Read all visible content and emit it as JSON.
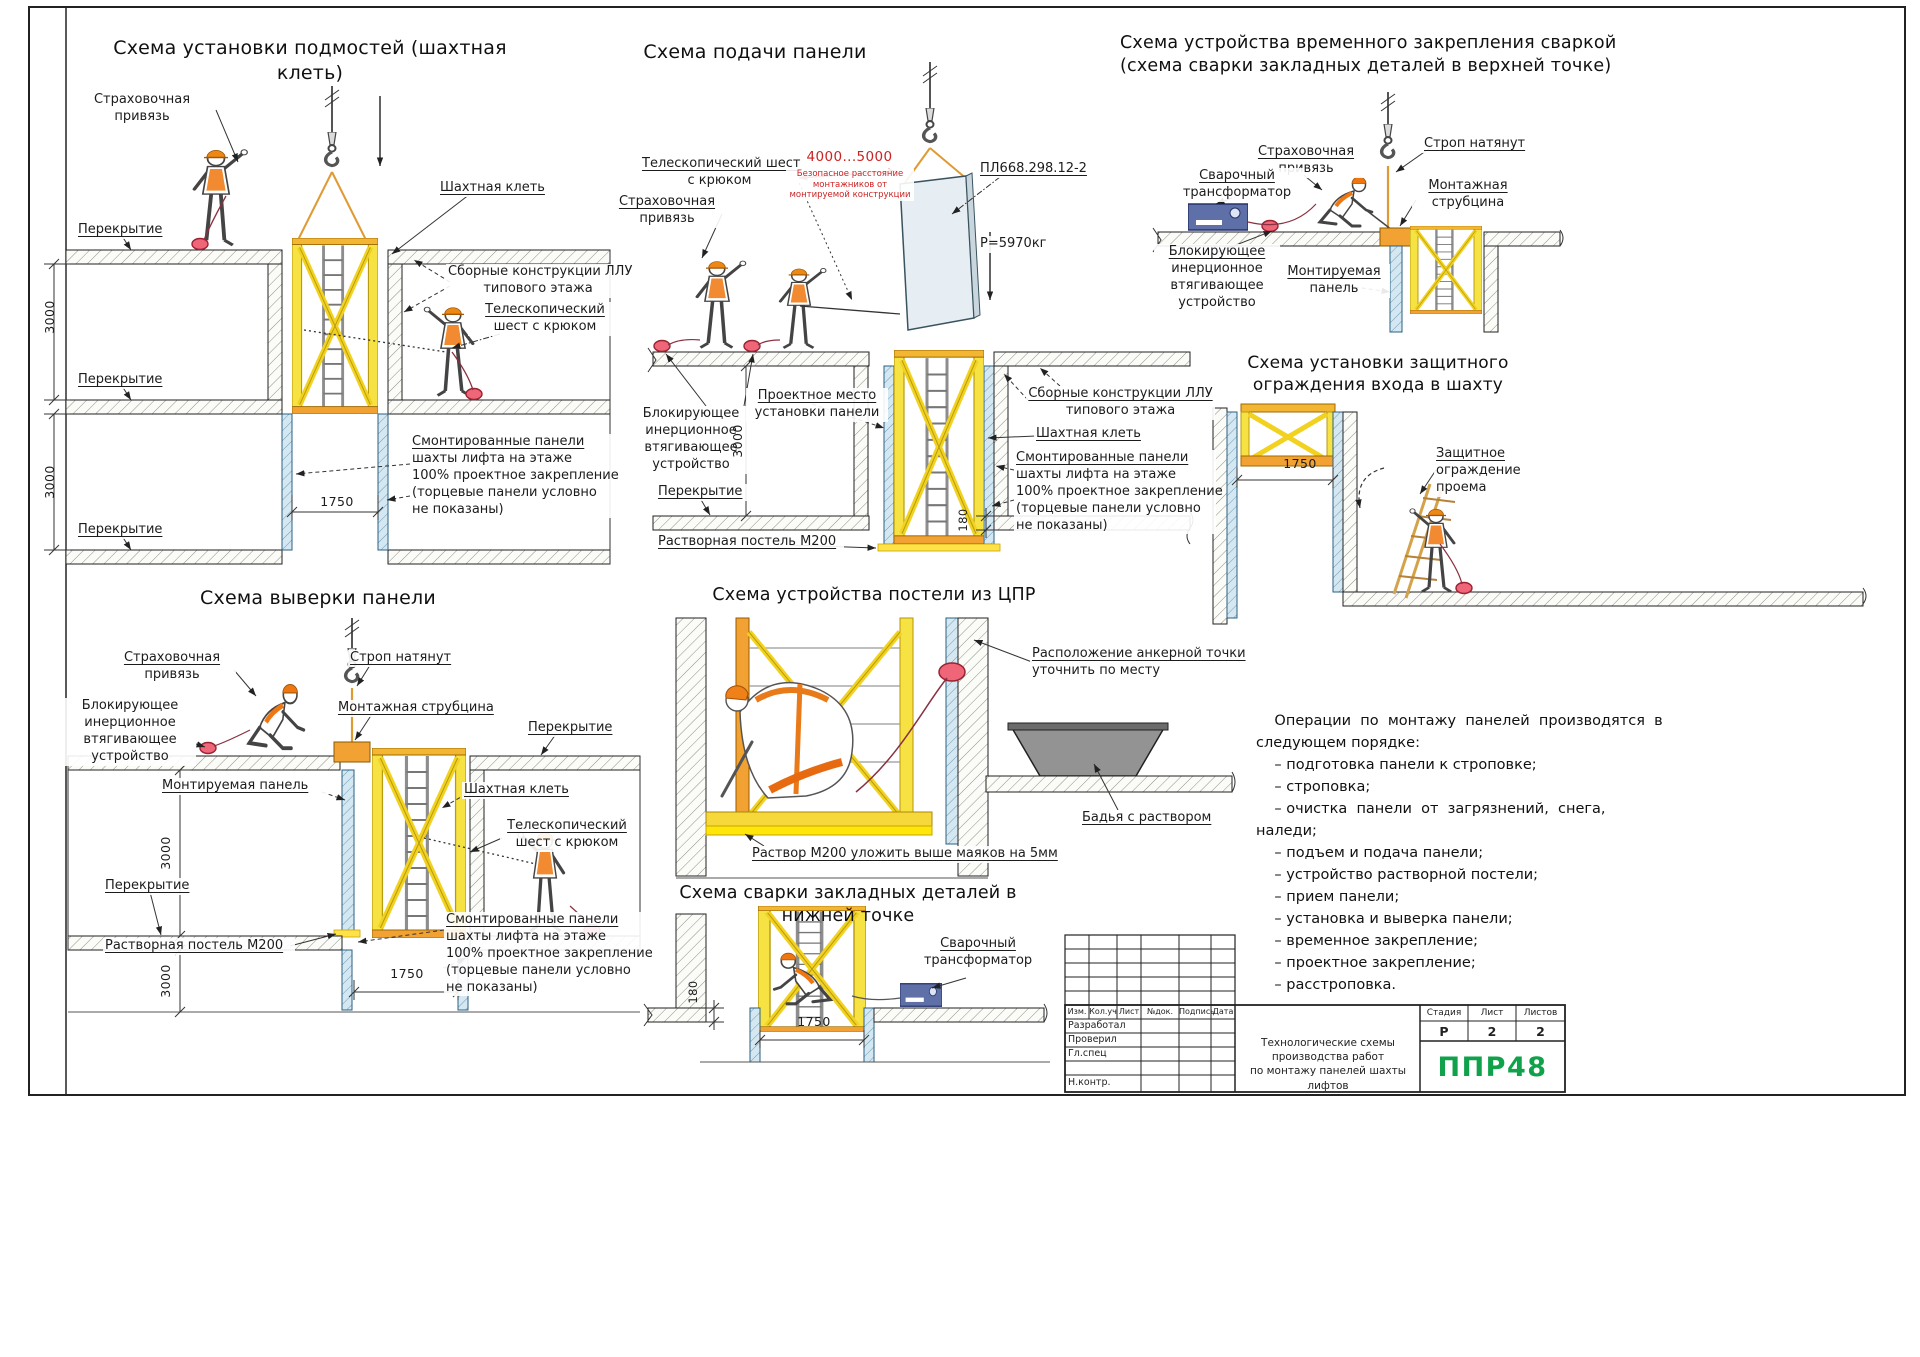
{
  "schemes": {
    "s1": {
      "title": "Схема установки подмостей (шахтная клеть)",
      "labels": {
        "harness": [
          "Страховочная",
          "привязь"
        ],
        "slab1": "Перекрытие",
        "slab2": "Перекрытие",
        "slab3": "Перекрытие",
        "cage": "Шахтная клеть",
        "precast": [
          "Сборные конструкции ЛЛУ",
          "типового этажа"
        ],
        "pole": [
          "Телескопический",
          "шест с крюком"
        ],
        "mounted": [
          "Смонтированные панели",
          "шахты лифта на этаже",
          "100% проектное закрепление",
          "(торцевые панели условно",
          "не показаны)"
        ],
        "dim_h1": "3000",
        "dim_h2": "3000",
        "dim_w": "1750"
      }
    },
    "s2": {
      "title": "Схема подачи панели",
      "labels": {
        "pole": [
          "Телескопический шест",
          "с крюком"
        ],
        "harness": [
          "Страховочная",
          "привязь"
        ],
        "safe_dim": "4000...5000",
        "safe_note": [
          "Безопасное расстояние",
          "монтажников от",
          "монтируемой конструкции"
        ],
        "panel_mark": "ПЛ668.298.12-2",
        "weight": "Р=5970кг",
        "blocker": [
          "Блокирующее",
          "инерционное",
          "втягивающее",
          "устройство"
        ],
        "place": [
          "Проектное место",
          "установки панели"
        ],
        "slab": "Перекрытие",
        "mortar": "Растворная постель М200",
        "precast": [
          "Сборные конструкции ЛЛУ",
          "типового этажа"
        ],
        "cage": "Шахтная клеть",
        "mounted": [
          "Смонтированные панели",
          "шахты лифта на этаже",
          "100% проектное закрепление",
          "(торцевые панели условно",
          "не показаны)"
        ],
        "dim_h": "3000",
        "dim_t": "180"
      }
    },
    "s3": {
      "title": [
        "Схема устройства временного закрепления сваркой",
        "(схема сварки закладных деталей в верхней точке)"
      ],
      "labels": {
        "harness": [
          "Страховочная",
          "привязь"
        ],
        "sling": "Строп натянут",
        "welder": [
          "Сварочный",
          "трансформатор"
        ],
        "clamp": [
          "Монтажная",
          "струбцина"
        ],
        "blocker": [
          "Блокирующее",
          "инерционное",
          "втягивающее",
          "устройство"
        ],
        "panel": [
          "Монтируемая",
          "панель"
        ]
      }
    },
    "s4": {
      "title": [
        "Схема установки защитного",
        "ограждения входа в шахту"
      ],
      "labels": {
        "dim_w": "1750",
        "guard": [
          "Защитное",
          "ограждение",
          "проема"
        ]
      }
    },
    "s5": {
      "title": "Схема выверки панели",
      "labels": {
        "harness": [
          "Страховочная",
          "привязь"
        ],
        "blocker": [
          "Блокирующее",
          "инерционное",
          "втягивающее",
          "устройство"
        ],
        "sling": "Строп натянут",
        "clamp": "Монтажная струбцина",
        "slab_r": "Перекрытие",
        "panel": "Монтируемая панель",
        "cage": "Шахтная клеть",
        "pole": [
          "Телескопический",
          "шест с крюком"
        ],
        "slab_l": "Перекрытие",
        "mortar": "Растворная постель М200",
        "mounted": [
          "Смонтированные панели",
          "шахты лифта на этаже",
          "100% проектное закрепление",
          "(торцевые панели условно",
          "не показаны)"
        ],
        "dim_h1": "3000",
        "dim_h2": "3000",
        "dim_w": "1750"
      }
    },
    "s6": {
      "title": "Схема устройства постели из ЦПР",
      "labels": {
        "anchor": [
          "Расположение анкерной точки",
          "уточнить по месту"
        ],
        "tub": "Бадья с раствором",
        "mortar": "Раствор М200 уложить выше маяков на 5мм"
      }
    },
    "s7": {
      "title": "Схема сварки закладных деталей в нижней точке",
      "labels": {
        "welder": [
          "Сварочный",
          "трансформатор"
        ],
        "dim_t": "180",
        "dim_w": "1750"
      }
    }
  },
  "notes": {
    "lines": [
      "    Операции  по  монтажу  панелей  производятся  в",
      "следующем порядке:",
      "    – подготовка панели к строповке;",
      "    – строповка;",
      "    – очистка  панели  от  загрязнений,  снега,",
      "наледи;",
      "    – подъем и подача панели;",
      "    – устройство растворной постели;",
      "    – прием панели;",
      "    – установка и выверка панели;",
      "    – временное закрепление;",
      "    – проектное закрепление;",
      "    – расстроповка."
    ]
  },
  "stamp": {
    "rev_cols": [
      "Изм.",
      "Кол.уч",
      "Лист",
      "№док.",
      "Подпись",
      "Дата"
    ],
    "sign_rows": [
      "Разработал",
      "Проверил",
      "Гл.спец",
      "",
      "Н.контр."
    ],
    "doc_title": [
      "Технологические схемы производства работ",
      "по монтажу панелей шахты лифтов"
    ],
    "stage_label": "Стадия",
    "sheet_label": "Лист",
    "sheets_label": "Листов",
    "stage": "Р",
    "sheet": "2",
    "sheets": "2",
    "logo": "ППР48"
  },
  "colors": {
    "cage_yellow": "#f7e244",
    "rail_orange": "#f2a232",
    "safety_red": "#cc2222",
    "panel_blue": "#d5e8f2",
    "logo_green": "#10a14b"
  }
}
